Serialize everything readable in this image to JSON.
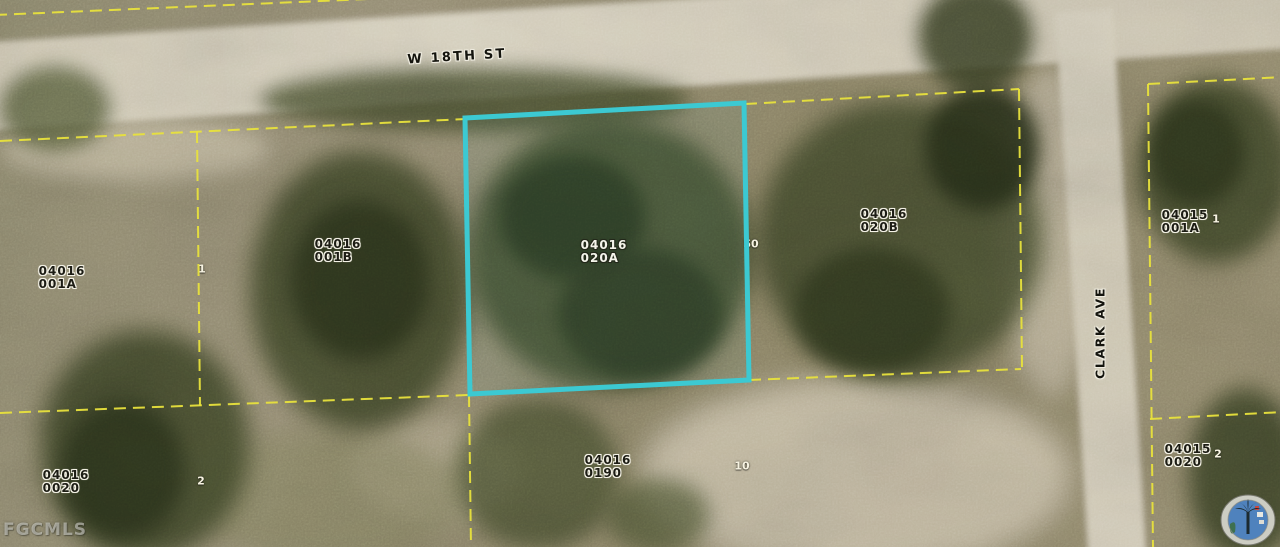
{
  "colors": {
    "highlight": "#3CC9D2",
    "parcel_line": "#E8E23C"
  },
  "streets": [
    {
      "name": "W 18TH ST"
    },
    {
      "name": "CLARK AVE"
    }
  ],
  "watermark": "FGCMLS",
  "parcels": [
    {
      "apn_line1": "04016",
      "apn_line2": "001A"
    },
    {
      "apn_line1": "04016",
      "apn_line2": "001B"
    },
    {
      "apn_line1": "04016",
      "apn_line2": "020A",
      "highlighted": true
    },
    {
      "apn_line1": "04016",
      "apn_line2": "020B"
    },
    {
      "apn_line1": "04015",
      "apn_line2": "001A"
    },
    {
      "apn_line1": "04016",
      "apn_line2": "0190"
    },
    {
      "apn_line1": "04016",
      "apn_line2": "0020"
    },
    {
      "apn_line1": "04015",
      "apn_line2": "0020"
    }
  ],
  "lot_numbers": [
    "1",
    "2",
    "50",
    "10",
    "1",
    "2"
  ]
}
